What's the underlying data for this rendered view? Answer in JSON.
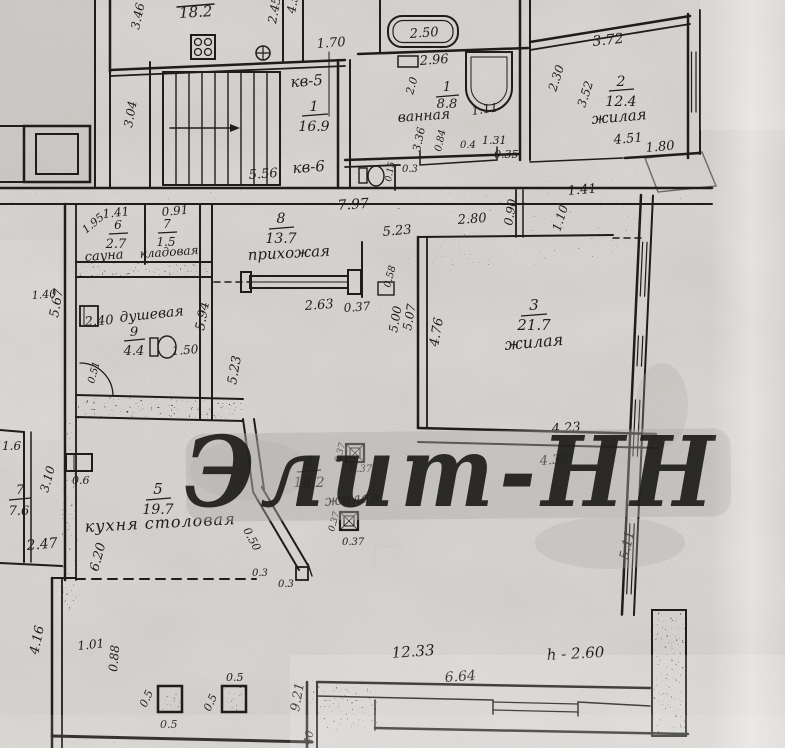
{
  "watermark": "Элит-НН",
  "stairwell": {
    "apt_label_5": "кв-5",
    "apt_label_6": "кв-6",
    "room_num": "1",
    "room_area": "16.9",
    "dims": {
      "d556": "5.56",
      "d797": "7.97",
      "d170": "1.70"
    }
  },
  "top_left_room": {
    "area": "18.2",
    "dims": {
      "d346": "3.46",
      "d304": "3.04",
      "d245": "2.45",
      "d45": "4.5"
    }
  },
  "bathroom": {
    "room_num": "1",
    "room_area": "8.8",
    "room_name": "ванная",
    "dims": {
      "d250": "2.50",
      "d296": "2.96",
      "d20": "2.0",
      "d111": "1.11",
      "d336": "3.36",
      "d084": "0.84",
      "d04": "0.4",
      "d131": "1.31",
      "d035": "0.35",
      "d015": "0.15",
      "d03": "0.3"
    }
  },
  "room2": {
    "room_num": "2",
    "room_area": "12.4",
    "room_name": "жилая",
    "dims": {
      "d372": "3.72",
      "d230": "2.30",
      "d352": "3.52",
      "d451": "4.51",
      "d180": "1.80",
      "d141": "1.41",
      "d090": "0.90",
      "d110": "1.10"
    }
  },
  "hallway": {
    "room_num": "8",
    "room_area": "13.7",
    "room_name": "прихожая",
    "dims": {
      "d523": "5.23",
      "d280": "2.80",
      "d263": "2.63",
      "d037": "0.37",
      "d058": "0.58"
    }
  },
  "sauna": {
    "room_num": "6",
    "room_area": "2.7",
    "room_name": "сауна",
    "dims": {
      "d141": "1.41",
      "d195": "1.95"
    }
  },
  "storage": {
    "room_num": "7",
    "room_area": "1.5",
    "room_name": "кладовая",
    "dims": {
      "d091": "0.91"
    }
  },
  "shower": {
    "room_num": "9",
    "room_area": "4.4",
    "room_name": "душевая",
    "dims": {
      "d240": "2.40",
      "d140": "1.40",
      "d150": "1.50",
      "d051": "0.51",
      "d567": "5.67",
      "d594": "5.94"
    }
  },
  "room3": {
    "room_num": "3",
    "room_area": "21.7",
    "room_name": "жилая",
    "dims": {
      "d500": "5.00",
      "d507": "5.07",
      "d476": "4.76",
      "d423": "4.23",
      "d439": "4.39",
      "d523": "5.23"
    }
  },
  "room4": {
    "room_num": "4",
    "room_area": "18.2",
    "room_name": "жилая",
    "dims": {
      "d037a": "0.37",
      "d037b": "0.37",
      "d037c": "0.37",
      "d037d": "0.37",
      "d050": "0.50",
      "d03a": "0.3",
      "d03b": "0.3"
    }
  },
  "kitchen": {
    "room_num": "5",
    "room_area": "19.7",
    "room_name": "кухня столовая",
    "dims": {
      "d06": "0.6",
      "d620": "6.20"
    }
  },
  "neighbor": {
    "room_num": "7",
    "room_area": "7.6",
    "dims": {
      "d16": "1.6",
      "d310": "3.10",
      "d247": "2.47",
      "d416": "4.16"
    }
  },
  "bottom": {
    "height_note": "h - 2.60",
    "dims": {
      "d101": "1.01",
      "d088": "0.88",
      "d05a": "0.5",
      "d05b": "0.5",
      "d05c": "0.5",
      "d05d": "0.5",
      "d921": "9.21",
      "d040": "40",
      "d1233": "12.33",
      "d664": "6.64"
    }
  },
  "right_wall": {
    "dims": {
      "d511": "5.11"
    }
  }
}
